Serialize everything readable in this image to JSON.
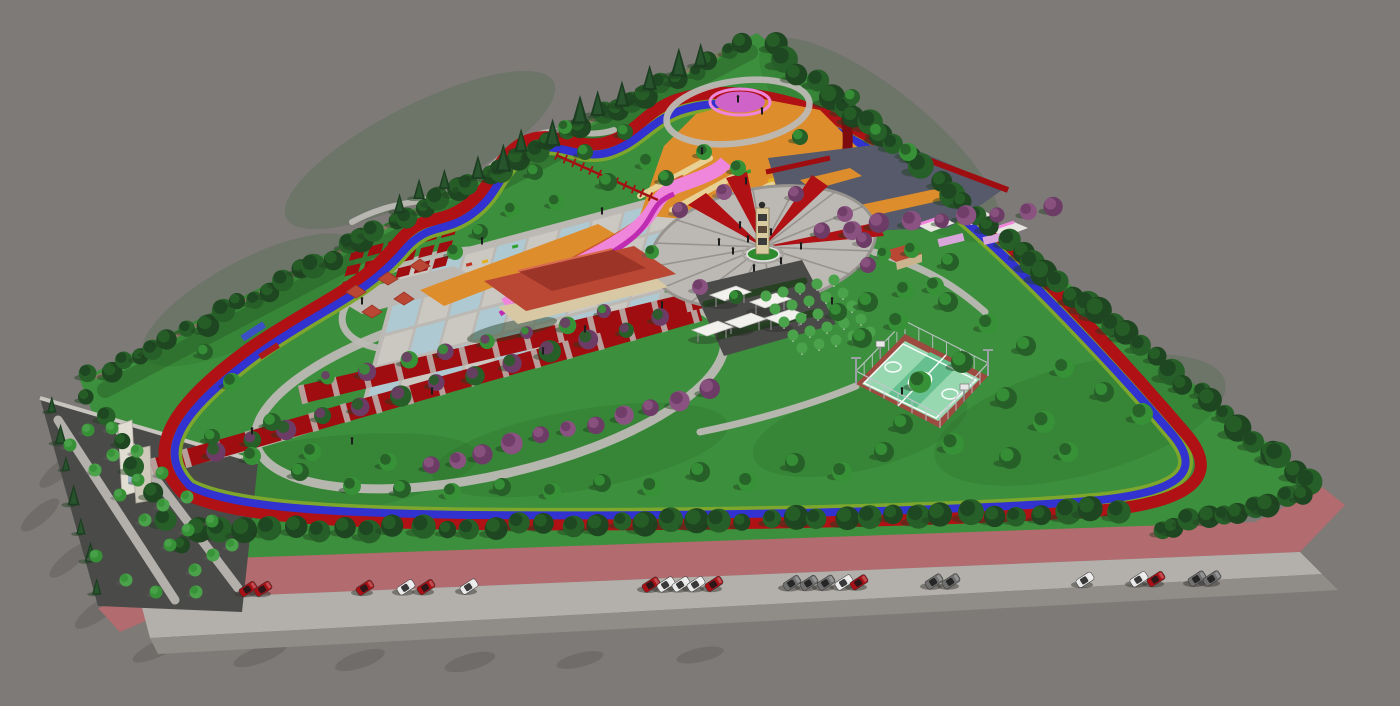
{
  "title": "Park master plan - 3D aerial render",
  "description": "Computer-generated aerial perspective of a triangular urban park with perimeter jogging and cycling tracks, central clock-tower plaza, reflecting pools, playgrounds and street parking.",
  "features": [
    {
      "label": "perimeter jogging track",
      "color_key": "trackRed"
    },
    {
      "label": "perimeter bike lane",
      "color_key": "trackBlue"
    },
    {
      "label": "central plaza with clock tower",
      "color_key": "paveLight"
    },
    {
      "label": "checkerboard reflecting pools",
      "color_key": "water"
    },
    {
      "label": "red pergola promenade",
      "color_key": "promenadeRed"
    },
    {
      "label": "basketball court",
      "color_key": "courtGreen"
    },
    {
      "label": "children playground (orange surface)",
      "color_key": "orange"
    },
    {
      "label": "pink loop garden",
      "color_key": "pinkPath"
    },
    {
      "label": "market tents",
      "color_key": "tentWhite"
    },
    {
      "label": "tree nursery grid",
      "color_key": "orchardGreen"
    },
    {
      "label": "street-side parking",
      "color_key": "parkingPink"
    },
    {
      "label": "entrance gate",
      "color_key": "gateCream"
    },
    {
      "label": "gazebo kiosks",
      "color_key": "roofRed"
    },
    {
      "label": "cafe building",
      "color_key": "roofRed"
    }
  ],
  "counts": {
    "parked_cars": 23,
    "market_tents": 5,
    "gazebo_kiosks": 5,
    "plaza_spokes": 16
  },
  "scene": {
    "colors": {
      "background": "#7d7a77",
      "grass": "#3c8f3c",
      "grassShade": "#1e5a1e",
      "treeDark": "#1e4620",
      "treeMid": "#275f28",
      "treeLight": "#379237",
      "pine": "#1b3d20",
      "pineLight": "#2a5a30",
      "plum": "#6d3c66",
      "plumLight": "#8a5280",
      "orchardGreen": "#4aa34a",
      "trackRed": "#b01114",
      "trackBlue": "#3132cf",
      "trackGreen": "#7fa62c",
      "promenadeRed": "#a00d10",
      "darkRed": "#7e0b0e",
      "paveLight": "#bcb9b4",
      "paveMid": "#a5a29d",
      "paveDark": "#4a4a48",
      "cobble": "#565a6a",
      "water": "#aec9d2",
      "checkerPave": "#cbc7c1",
      "orange": "#de8d2c",
      "pinkPath": "#ef86dc",
      "magenta": "#bf2cb2",
      "violet": "#cf63c8",
      "lilac": "#d9a6dc",
      "courtGreen": "#97d8b0",
      "courtStripe": "#66bf8e",
      "courtBorder": "#9d4b41",
      "roofRed": "#b94734",
      "roofDark": "#9c3427",
      "cream": "#e6d9ba",
      "wallCream": "#d8c8a4",
      "tentWhite": "#f2f1ee",
      "gateCream": "#e2ddd2",
      "parkingPink": "#b26b6e",
      "roadLight": "#b3b0ab",
      "roadMid": "#908d89",
      "carRed": "#a81016",
      "carWhite": "#e9e9e9",
      "carGray": "#707070",
      "shadowGrass": "#1f3d1f",
      "shadowPave": "#615e5b",
      "fenceBrown": "#96766a",
      "beamYellow": "#ead9a0"
    },
    "plaza": {
      "cx": 763,
      "cy": 247,
      "rx": 114,
      "ry": 59,
      "rot": -10,
      "spokes": 16
    },
    "checkerboard": {
      "translate": [
        368,
        398
      ],
      "rotate": -15,
      "skewX": -30,
      "rows": 4,
      "cols": 9,
      "tileW": 30,
      "tileH": 26,
      "gap": 3
    },
    "courtyard": {
      "translate": [
        340,
        292
      ],
      "rotate": -14,
      "skewX": -30,
      "rows": 3,
      "cols": 6,
      "tileW": 14,
      "tileH": 9,
      "gap": 5
    },
    "court": {
      "corners": [
        [
          905,
          334
        ],
        [
          988,
          376
        ],
        [
          940,
          428
        ],
        [
          856,
          384
        ]
      ],
      "posts": 7,
      "postH": 13
    },
    "orchard": {
      "origin": [
        766,
        296
      ],
      "u": [
        17,
        -4
      ],
      "v": [
        9,
        13
      ],
      "rows": 5,
      "cols": 5,
      "r": 5.5
    },
    "tents": [
      [
        730,
        295
      ],
      [
        770,
        302
      ],
      [
        745,
        322
      ],
      [
        785,
        318
      ],
      [
        712,
        330
      ]
    ],
    "cars": [
      {
        "x": 248,
        "c": "red"
      },
      {
        "x": 263,
        "c": "red"
      },
      {
        "x": 365,
        "c": "red"
      },
      {
        "x": 406,
        "c": "white"
      },
      {
        "x": 426,
        "c": "red"
      },
      {
        "x": 469,
        "c": "white"
      },
      {
        "x": 651,
        "c": "red"
      },
      {
        "x": 666,
        "c": "white"
      },
      {
        "x": 681,
        "c": "white"
      },
      {
        "x": 696,
        "c": "white"
      },
      {
        "x": 714,
        "c": "red"
      },
      {
        "x": 792,
        "c": "gray"
      },
      {
        "x": 809,
        "c": "gray"
      },
      {
        "x": 826,
        "c": "gray"
      },
      {
        "x": 844,
        "c": "white"
      },
      {
        "x": 859,
        "c": "red"
      },
      {
        "x": 934,
        "c": "gray"
      },
      {
        "x": 951,
        "c": "gray"
      },
      {
        "x": 1085,
        "c": "white"
      },
      {
        "x": 1139,
        "c": "white"
      },
      {
        "x": 1156,
        "c": "red"
      },
      {
        "x": 1197,
        "c": "gray"
      },
      {
        "x": 1212,
        "c": "gray"
      }
    ],
    "tree_lines": [
      {
        "name": "right-boundary",
        "from": [
          772,
          48
        ],
        "to": [
          1310,
          482
        ],
        "count": 40,
        "r": 11,
        "colors": [
          "treeDark",
          "treeMid"
        ],
        "jitter": 5
      },
      {
        "name": "left-boundary",
        "from": [
          92,
          378
        ],
        "to": [
          742,
          44
        ],
        "count": 42,
        "r": 10,
        "colors": [
          "treeMid",
          "treeDark"
        ],
        "jitter": 5
      },
      {
        "name": "left-boundary-pines",
        "from": [
          398,
          214
        ],
        "to": [
          700,
          58
        ],
        "count": 13,
        "r": 9,
        "type": "pine",
        "jitter": 6
      },
      {
        "name": "bottom-hedge",
        "from": [
          196,
          532
        ],
        "to": [
          1118,
          512
        ],
        "count": 38,
        "r": 10.5,
        "colors": [
          "treeDark",
          "treeMid"
        ],
        "jitter": 4
      },
      {
        "name": "bottom-right-edge",
        "from": [
          1160,
          530
        ],
        "to": [
          1300,
          494
        ],
        "count": 10,
        "r": 10,
        "colors": [
          "treeMid",
          "treeDark"
        ],
        "jitter": 4
      },
      {
        "name": "lot-west-pines",
        "from": [
          50,
          408
        ],
        "to": [
          98,
          590
        ],
        "count": 7,
        "r": 7,
        "type": "pine",
        "jitter": 3
      },
      {
        "name": "left-corner-row",
        "from": [
          88,
          394
        ],
        "to": [
          182,
          544
        ],
        "count": 7,
        "r": 9,
        "colors": [
          "treeDark",
          "treeMid"
        ],
        "jitter": 3
      },
      {
        "name": "promenade-plums",
        "from": [
          212,
          448
        ],
        "to": [
          660,
          320
        ],
        "count": 13,
        "r": 9,
        "colors": [
          "plum",
          "treeMid"
        ],
        "jitter": 4
      },
      {
        "name": "promenade-upper-row",
        "from": [
          330,
          380
        ],
        "to": [
          606,
          314
        ],
        "count": 8,
        "r": 7.5,
        "colors": [
          "treeLight",
          "plum"
        ],
        "jitter": 3
      },
      {
        "name": "pond-south-plums",
        "from": [
          428,
          468
        ],
        "to": [
          710,
          392
        ],
        "count": 11,
        "r": 9,
        "colors": [
          "plum",
          "plumLight"
        ],
        "jitter": 4
      },
      {
        "name": "ne-plum-row",
        "from": [
          824,
          232
        ],
        "to": [
          1054,
          206
        ],
        "count": 9,
        "r": 8.5,
        "colors": [
          "plum",
          "plumLight"
        ],
        "jitter": 3
      }
    ],
    "tree_clusters": [
      {
        "name": "lawn-trees",
        "colors": [
          "treeMid",
          "treeLight"
        ],
        "shadow": "shadowGrass",
        "defaultR": 10,
        "points": [
          [
            948,
            302
          ],
          [
            988,
            324
          ],
          [
            1026,
            346
          ],
          [
            1064,
            368
          ],
          [
            1104,
            392
          ],
          [
            1142,
            414,
            11
          ],
          [
            1006,
            398,
            11
          ],
          [
            1044,
            422,
            11
          ],
          [
            962,
            362,
            11
          ],
          [
            920,
            382,
            11
          ],
          [
            903,
            424
          ],
          [
            953,
            444,
            11
          ],
          [
            1010,
            458,
            11
          ],
          [
            1068,
            452
          ],
          [
            884,
            452
          ],
          [
            842,
            472
          ],
          [
            795,
            463
          ],
          [
            748,
            482
          ],
          [
            700,
            472
          ],
          [
            652,
            487
          ],
          [
            602,
            483,
            9
          ],
          [
            552,
            492,
            9
          ],
          [
            502,
            487,
            9
          ],
          [
            452,
            492,
            9
          ],
          [
            402,
            489,
            9
          ],
          [
            352,
            486,
            9
          ],
          [
            300,
            472,
            9
          ],
          [
            252,
            456,
            9
          ],
          [
            212,
            437,
            8
          ],
          [
            232,
            382,
            9
          ],
          [
            272,
            422,
            9
          ],
          [
            312,
            452,
            9
          ],
          [
            205,
            352,
            8
          ],
          [
            388,
            462,
            9
          ],
          [
            868,
            302
          ],
          [
            898,
            322
          ],
          [
            838,
            312,
            9
          ],
          [
            905,
            290,
            9
          ],
          [
            862,
            338
          ],
          [
            912,
            250,
            8
          ],
          [
            950,
            262,
            9
          ],
          [
            935,
            286,
            9
          ],
          [
            608,
            182,
            9
          ],
          [
            648,
            162,
            9
          ],
          [
            585,
            152,
            8
          ],
          [
            556,
            202,
            8
          ],
          [
            666,
            178,
            8
          ],
          [
            704,
            152,
            8
          ],
          [
            625,
            132,
            8
          ],
          [
            565,
            127,
            7
          ],
          [
            535,
            172,
            8
          ],
          [
            512,
            210,
            8
          ],
          [
            480,
            232,
            8
          ],
          [
            455,
            252,
            8
          ],
          [
            878,
            132,
            9
          ],
          [
            908,
            152,
            9
          ],
          [
            852,
            97,
            8
          ],
          [
            738,
            168,
            8
          ],
          [
            800,
            137,
            8
          ]
        ]
      },
      {
        "name": "plaza-plums",
        "colors": [
          "plum",
          "plumLight"
        ],
        "shadow": "shadowPave",
        "defaultR": 8,
        "points": [
          [
            680,
            210
          ],
          [
            724,
            192
          ],
          [
            796,
            194
          ],
          [
            845,
            214
          ],
          [
            864,
            240
          ],
          [
            700,
            287
          ],
          [
            868,
            265
          ]
        ]
      },
      {
        "name": "plaza-greens",
        "colors": [
          "treeLight",
          "treeMid"
        ],
        "shadow": "shadowPave",
        "defaultR": 7,
        "points": [
          [
            652,
            252
          ],
          [
            736,
            297
          ],
          [
            884,
            254
          ]
        ]
      },
      {
        "name": "lot-trees",
        "colors": [
          "treeLight",
          "orchardGreen"
        ],
        "shadow": "shadowPave",
        "defaultR": 6.5,
        "points": [
          [
            70,
            445
          ],
          [
            95,
            470
          ],
          [
            120,
            495
          ],
          [
            145,
            520
          ],
          [
            170,
            545
          ],
          [
            195,
            570
          ],
          [
            88,
            430
          ],
          [
            113,
            455
          ],
          [
            138,
            480
          ],
          [
            163,
            505
          ],
          [
            188,
            530
          ],
          [
            213,
            555
          ],
          [
            112,
            428
          ],
          [
            137,
            451
          ],
          [
            162,
            473
          ],
          [
            187,
            497
          ],
          [
            212,
            521
          ],
          [
            232,
            545
          ],
          [
            96,
            556
          ],
          [
            126,
            580
          ],
          [
            156,
            592
          ],
          [
            196,
            592
          ]
        ]
      }
    ],
    "people": [
      [
        733,
        252
      ],
      [
        748,
        240
      ],
      [
        781,
        262
      ],
      [
        801,
        247
      ],
      [
        754,
        269
      ],
      [
        719,
        243
      ],
      [
        771,
        233
      ],
      [
        740,
        226
      ],
      [
        662,
        306
      ],
      [
        543,
        352
      ],
      [
        432,
        392
      ],
      [
        362,
        302
      ],
      [
        482,
        242
      ],
      [
        602,
        212
      ],
      [
        832,
        302
      ],
      [
        902,
        392
      ],
      [
        352,
        442
      ],
      [
        252,
        432
      ],
      [
        702,
        152
      ],
      [
        762,
        112
      ],
      [
        746,
        182
      ],
      [
        585,
        330
      ],
      [
        738,
        100
      ]
    ]
  }
}
